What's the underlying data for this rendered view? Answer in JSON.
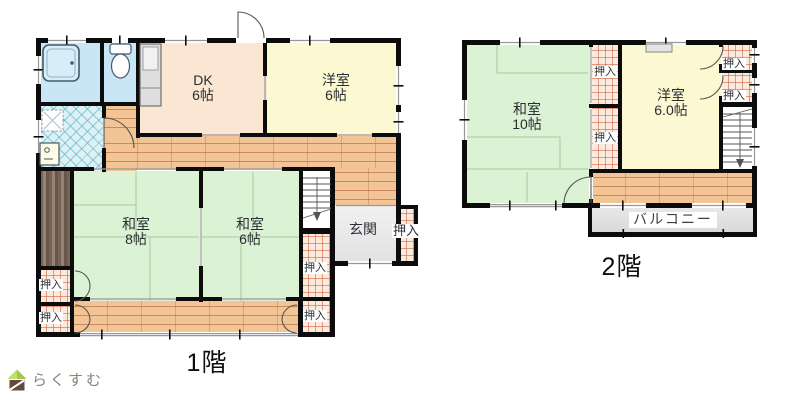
{
  "floor1": {
    "label": "1階",
    "rooms": {
      "dk": {
        "name": "DK",
        "size": "6帖"
      },
      "youshitsu": {
        "name": "洋室",
        "size": "6帖"
      },
      "washitsu8": {
        "name": "和室",
        "size": "8帖"
      },
      "washitsu6": {
        "name": "和室",
        "size": "6帖"
      },
      "genkan": {
        "name": "玄関"
      }
    }
  },
  "floor2": {
    "label": "2階",
    "rooms": {
      "washitsu10": {
        "name": "和室",
        "size": "10帖"
      },
      "youshitsu": {
        "name": "洋室",
        "size": "6.0帖"
      },
      "balcony": {
        "name": "バルコニー"
      }
    }
  },
  "labels": {
    "closet": "押入"
  },
  "logo": {
    "text": "らくすむ"
  },
  "colors": {
    "wall": "#0c0c0c",
    "tatami": "#dcf2d4",
    "western_room": "#fcf8d2",
    "dining_kitchen": "#fae6d2",
    "flooring": "#f3c496",
    "closet_grid": "#cc5530",
    "water_area": "#c9e6f6",
    "washroom_tile": "#ddf1f5",
    "entrance": "#ececec",
    "balcony": "#dedede",
    "logo_green": "#a6c73f",
    "logo_brown": "#5d4c3f"
  }
}
